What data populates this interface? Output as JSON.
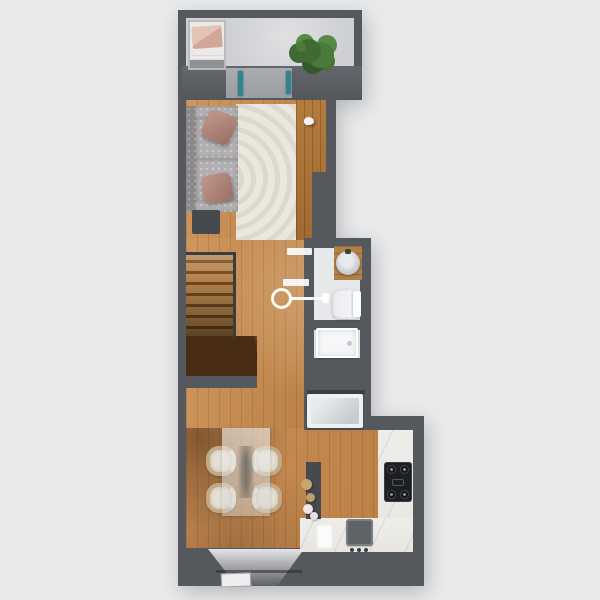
{
  "scene": {
    "type": "3d-top-down-floor-plan",
    "rooms": [
      {
        "name": "balcony",
        "position": "top"
      },
      {
        "name": "living-room",
        "position": "upper"
      },
      {
        "name": "hallway-stairs",
        "position": "middle-left"
      },
      {
        "name": "bathroom",
        "position": "middle-right"
      },
      {
        "name": "shower-room",
        "position": "middle-right-lower"
      },
      {
        "name": "kitchen-dining",
        "position": "lower"
      },
      {
        "name": "entry",
        "position": "bottom"
      }
    ],
    "objects": [
      "lounger",
      "potted-plant",
      "sliding-glass-door",
      "sofa",
      "throw-pillows",
      "area-rug",
      "side-table",
      "bird-figurine",
      "staircase",
      "wall-ring-decor",
      "open-door-panels",
      "vanity-with-round-sink",
      "toilet",
      "shower-tray",
      "washing-machine",
      "shelf",
      "marble-counter-l-shape",
      "stove-cooktop",
      "kitchen-sink",
      "faucet",
      "kitchen-towel",
      "partition-wall",
      "decor-vases",
      "glass-dining-table",
      "dining-chairs-x4",
      "entry-door-light",
      "door-mat"
    ]
  },
  "colors": {
    "background": "#e9eaec",
    "wall": "#55585d",
    "wall_dark": "#46494e",
    "concrete": "#cfd0d3",
    "wood": "#c68c52",
    "rug": "#ebe7de",
    "sofa": "#a3a0a2",
    "pillow": "#b3837b",
    "mattress": "#eceae8",
    "glass_teal": "#2f858d",
    "bath_floor": "#e7e8ea",
    "white_fixture": "#f5f6f7",
    "marble": "#edebe6",
    "stove_black": "#1e1f22",
    "sink_gray": "#5f6267",
    "chair_cream": "#e5dfd3",
    "chair_wood": "#c3aa87",
    "vase_beige": "#c8a76e",
    "plant_green": "#4c7a3d"
  }
}
